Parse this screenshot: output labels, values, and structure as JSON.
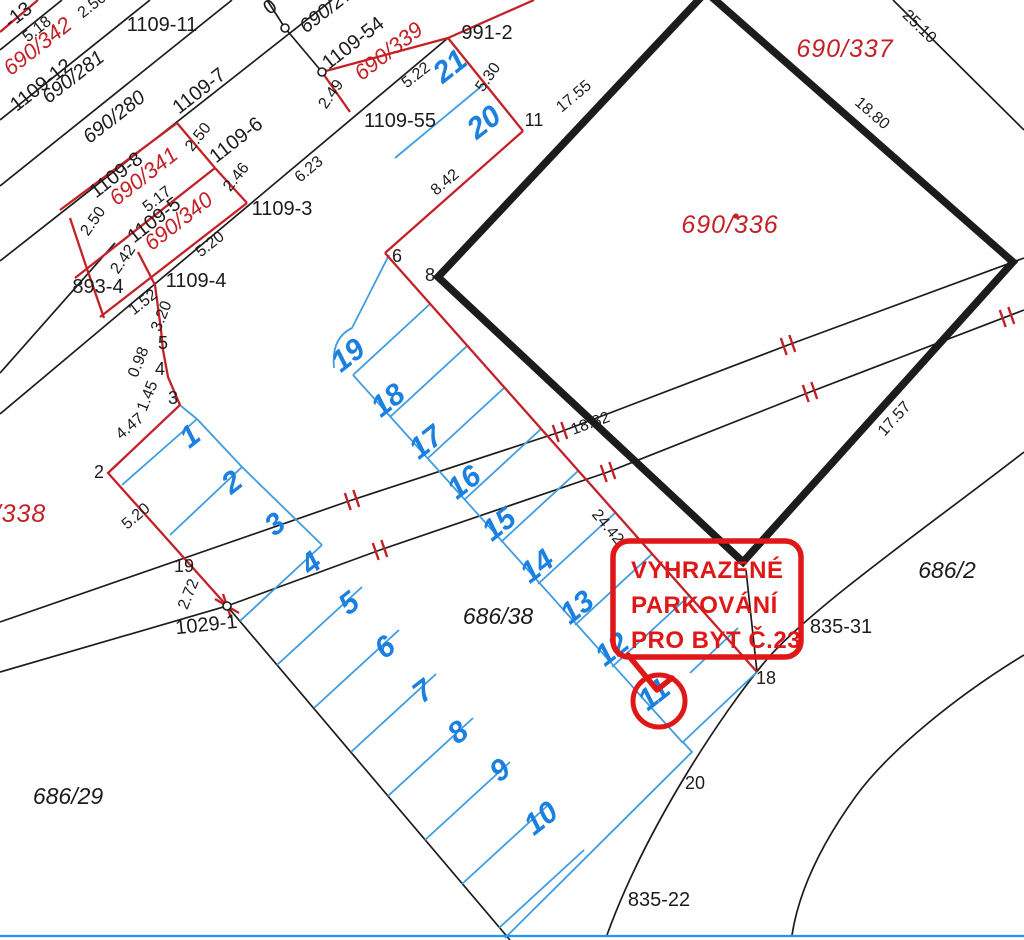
{
  "map": {
    "title": "cadastral-parcel-map",
    "colors": {
      "black": "#1c1c1c",
      "red_line": "#c42127",
      "red_text": "#c42127",
      "callout_red": "#e01717",
      "blue_number": "#1b80e0",
      "blue_line": "#3f9ce2",
      "background": "#ffffff"
    },
    "callout": {
      "lines": [
        "VYHRAZENÉ",
        "PARKOVÁNÍ",
        "PRO BYT Č.23"
      ],
      "box": [
        613,
        541,
        188,
        116,
        16
      ],
      "tail_path": "M628,655 L657,690 L672,678",
      "circle": [
        659,
        701,
        26
      ],
      "text_x": 631,
      "text_ys": [
        578,
        613,
        648
      ]
    },
    "labels": [
      {
        "t": "-13",
        "x": 22,
        "y": 20,
        "r": -38,
        "c": "pid",
        "s": 18
      },
      {
        "t": "2.50",
        "x": 95,
        "y": 9,
        "r": -38,
        "c": "dim"
      },
      {
        "t": "0",
        "x": 274,
        "y": 12,
        "r": -38,
        "c": "pid"
      },
      {
        "t": "5.18",
        "x": 40,
        "y": 33,
        "r": -38,
        "c": "dim"
      },
      {
        "t": "1109-11",
        "x": 162,
        "y": 31,
        "r": 0,
        "c": "pid"
      },
      {
        "t": "1109-12",
        "x": 45,
        "y": 90,
        "r": -38,
        "c": "pid"
      },
      {
        "t": "690/281",
        "x": 77,
        "y": 82,
        "r": -38,
        "c": "pidi"
      },
      {
        "t": "690/280",
        "x": 118,
        "y": 122,
        "r": -38,
        "c": "pidi"
      },
      {
        "t": "1109-7",
        "x": 203,
        "y": 96,
        "r": -38,
        "c": "pid"
      },
      {
        "t": "2.50",
        "x": 202,
        "y": 140,
        "r": -52,
        "c": "dim"
      },
      {
        "t": "1109-6",
        "x": 240,
        "y": 145,
        "r": -38,
        "c": "pid"
      },
      {
        "t": "2.46",
        "x": 240,
        "y": 180,
        "r": -52,
        "c": "dim"
      },
      {
        "t": "6.23",
        "x": 312,
        "y": 173,
        "r": -40,
        "c": "dim"
      },
      {
        "t": "1109-8",
        "x": 120,
        "y": 180,
        "r": -38,
        "c": "pid"
      },
      {
        "t": "5.17",
        "x": 160,
        "y": 203,
        "r": -38,
        "c": "dim"
      },
      {
        "t": "1109-5",
        "x": 158,
        "y": 225,
        "r": -38,
        "c": "pid"
      },
      {
        "t": "2.50",
        "x": 97,
        "y": 224,
        "r": -55,
        "c": "dim"
      },
      {
        "t": "2.42",
        "x": 127,
        "y": 262,
        "r": -55,
        "c": "dim"
      },
      {
        "t": "5.20",
        "x": 213,
        "y": 248,
        "r": -38,
        "c": "dim"
      },
      {
        "t": "1109-3",
        "x": 282,
        "y": 215,
        "r": 0,
        "c": "pid"
      },
      {
        "t": "1109-4",
        "x": 196,
        "y": 287,
        "r": 0,
        "c": "pid"
      },
      {
        "t": "893-4",
        "x": 98,
        "y": 293,
        "r": 0,
        "c": "pid"
      },
      {
        "t": "1.52",
        "x": 146,
        "y": 306,
        "r": -38,
        "c": "dim"
      },
      {
        "t": "3.20",
        "x": 166,
        "y": 318,
        "r": -68,
        "c": "dim"
      },
      {
        "t": "5",
        "x": 163,
        "y": 349,
        "r": 0,
        "c": "pt"
      },
      {
        "t": "0.98",
        "x": 143,
        "y": 364,
        "r": -68,
        "c": "dim"
      },
      {
        "t": "4",
        "x": 160,
        "y": 375,
        "r": 0,
        "c": "pt"
      },
      {
        "t": "1.45",
        "x": 152,
        "y": 398,
        "r": -68,
        "c": "dim"
      },
      {
        "t": "3",
        "x": 173,
        "y": 404,
        "r": 0,
        "c": "pt"
      },
      {
        "t": "4.47",
        "x": 133,
        "y": 430,
        "r": -40,
        "c": "dim"
      },
      {
        "t": "2",
        "x": 99,
        "y": 478,
        "r": 0,
        "c": "pt"
      },
      {
        "t": "5.20",
        "x": 139,
        "y": 520,
        "r": -40,
        "c": "dim"
      },
      {
        "t": "19",
        "x": 184,
        "y": 572,
        "r": 0,
        "c": "pt"
      },
      {
        "t": "2.72",
        "x": 193,
        "y": 596,
        "r": -68,
        "c": "dim"
      },
      {
        "t": "1029-1",
        "x": 207,
        "y": 631,
        "r": -6,
        "c": "pid"
      },
      {
        "t": "690/27",
        "x": 330,
        "y": 15,
        "r": -38,
        "c": "pidi"
      },
      {
        "t": "1109-54",
        "x": 357,
        "y": 48,
        "r": -38,
        "c": "pid"
      },
      {
        "t": "5.22",
        "x": 419,
        "y": 79,
        "r": -38,
        "c": "dim"
      },
      {
        "t": "991-2",
        "x": 487,
        "y": 39,
        "r": 0,
        "c": "pid"
      },
      {
        "t": "5.30",
        "x": 492,
        "y": 80,
        "r": -55,
        "c": "dim"
      },
      {
        "t": "11",
        "x": 534,
        "y": 126,
        "r": 0,
        "c": "pt"
      },
      {
        "t": "17.55",
        "x": 577,
        "y": 100,
        "r": -40,
        "c": "dim"
      },
      {
        "t": "8.42",
        "x": 448,
        "y": 186,
        "r": -40,
        "c": "dim"
      },
      {
        "t": "2.49",
        "x": 335,
        "y": 97,
        "r": -55,
        "c": "dim"
      },
      {
        "t": "1109-55",
        "x": 400,
        "y": 127,
        "r": 0,
        "c": "pid"
      },
      {
        "t": "6",
        "x": 397,
        "y": 262,
        "r": 0,
        "c": "pt"
      },
      {
        "t": "8",
        "x": 430,
        "y": 281,
        "r": 0,
        "c": "pt"
      },
      {
        "t": "25.10",
        "x": 916,
        "y": 30,
        "r": 44,
        "c": "dim"
      },
      {
        "t": "18.80",
        "x": 869,
        "y": 117,
        "r": 41,
        "c": "dim"
      },
      {
        "t": "17.57",
        "x": 898,
        "y": 422,
        "r": -48,
        "c": "dim"
      },
      {
        "t": "18.82",
        "x": 592,
        "y": 428,
        "r": -20,
        "c": "dim"
      },
      {
        "t": "24.42",
        "x": 604,
        "y": 530,
        "r": 50,
        "c": "dim"
      },
      {
        "t": "686/38",
        "x": 498,
        "y": 624,
        "r": 0,
        "c": "pidb"
      },
      {
        "t": "686/29",
        "x": 68,
        "y": 804,
        "r": 0,
        "c": "pidb"
      },
      {
        "t": "686/2",
        "x": 947,
        "y": 578,
        "r": 0,
        "c": "pidb"
      },
      {
        "t": "835-31",
        "x": 841,
        "y": 633,
        "r": 0,
        "c": "pid"
      },
      {
        "t": "18",
        "x": 766,
        "y": 684,
        "r": 0,
        "c": "pt"
      },
      {
        "t": "20",
        "x": 695,
        "y": 789,
        "r": 0,
        "c": "pt"
      },
      {
        "t": "835-22",
        "x": 659,
        "y": 906,
        "r": 0,
        "c": "pid"
      },
      {
        "t": "690/342",
        "x": 42,
        "y": 52,
        "r": -38,
        "c": "red"
      },
      {
        "t": "690/341",
        "x": 148,
        "y": 182,
        "r": -38,
        "c": "red"
      },
      {
        "t": "690/340",
        "x": 183,
        "y": 227,
        "r": -38,
        "c": "red"
      },
      {
        "t": "690/339",
        "x": 393,
        "y": 57,
        "r": -38,
        "c": "red"
      },
      {
        "t": "690/337",
        "x": 845,
        "y": 57,
        "r": 0,
        "c": "redbig"
      },
      {
        "t": "690/336",
        "x": 730,
        "y": 233,
        "r": 0,
        "c": "redbig"
      },
      {
        "t": "/338",
        "x": 20,
        "y": 522,
        "r": 0,
        "c": "redbig"
      }
    ],
    "stall_numbers": [
      {
        "n": "1",
        "x": 196,
        "y": 444
      },
      {
        "n": "2",
        "x": 238,
        "y": 490
      },
      {
        "n": "3",
        "x": 281,
        "y": 532
      },
      {
        "n": "4",
        "x": 317,
        "y": 571
      },
      {
        "n": "5",
        "x": 355,
        "y": 611
      },
      {
        "n": "6",
        "x": 391,
        "y": 655
      },
      {
        "n": "7",
        "x": 429,
        "y": 699
      },
      {
        "n": "8",
        "x": 464,
        "y": 740
      },
      {
        "n": "9",
        "x": 506,
        "y": 778
      },
      {
        "n": "10",
        "x": 547,
        "y": 826
      },
      {
        "n": "11",
        "x": 660,
        "y": 702
      },
      {
        "n": "12",
        "x": 618,
        "y": 657
      },
      {
        "n": "13",
        "x": 583,
        "y": 615
      },
      {
        "n": "14",
        "x": 543,
        "y": 574
      },
      {
        "n": "15",
        "x": 505,
        "y": 532
      },
      {
        "n": "16",
        "x": 470,
        "y": 490
      },
      {
        "n": "17",
        "x": 432,
        "y": 450
      },
      {
        "n": "18",
        "x": 394,
        "y": 408
      },
      {
        "n": "19",
        "x": 354,
        "y": 363
      },
      {
        "n": "20",
        "x": 490,
        "y": 130
      },
      {
        "n": "21",
        "x": 456,
        "y": 74
      }
    ],
    "geometry": {
      "black_segments": [
        [
          62,
          0,
          0,
          50
        ],
        [
          150,
          0,
          0,
          120
        ],
        [
          232,
          0,
          0,
          186
        ],
        [
          332,
          0,
          0,
          261
        ],
        [
          448,
          38,
          0,
          414
        ],
        [
          0,
          373,
          115,
          243
        ],
        [
          267,
          0,
          285,
          28
        ],
        [
          285,
          28,
          322,
          72
        ],
        [
          893,
          0,
          1024,
          130
        ],
        [
          227,
          606,
          510,
          940
        ],
        [
          746,
          570,
          757,
          672
        ]
      ],
      "black_polylines": [
        [
          [
            0,
            622
          ],
          [
            352,
            500
          ],
          [
            560,
            432
          ],
          [
            788,
            345
          ],
          [
            1024,
            258
          ]
        ],
        [
          [
            0,
            672
          ],
          [
            227,
            606
          ],
          [
            380,
            550
          ],
          [
            608,
            472
          ],
          [
            810,
            392
          ],
          [
            1024,
            310
          ]
        ]
      ],
      "black_paths": [
        "M1024,452 C930,525 815,605 768,658 C720,715 645,830 607,935",
        "M1024,655 C955,697 888,752 856,796 C822,843 799,890 792,935"
      ],
      "building_path": "M706,-8 L438,277 L743,562 L1013,262 Z",
      "red_segments": [
        [
          0,
          32,
          38,
          0
        ],
        [
          60,
          210,
          177,
          123
        ],
        [
          75,
          278,
          215,
          168
        ],
        [
          100,
          317,
          247,
          203
        ],
        [
          177,
          123,
          215,
          168
        ],
        [
          215,
          168,
          247,
          203
        ],
        [
          70,
          218,
          86,
          266
        ],
        [
          86,
          266,
          104,
          318
        ],
        [
          534,
          0,
          448,
          38
        ],
        [
          448,
          38,
          322,
          72
        ],
        [
          322,
          72,
          350,
          112
        ],
        [
          448,
          38,
          523,
          131
        ],
        [
          523,
          131,
          385,
          253
        ],
        [
          385,
          253,
          757,
          672
        ]
      ],
      "red_polylines": [
        [
          [
            138,
            252
          ],
          [
            155,
            285
          ],
          [
            161,
            330
          ],
          [
            163,
            350
          ],
          [
            168,
            377
          ],
          [
            180,
            405
          ],
          [
            108,
            473
          ],
          [
            227,
            606
          ]
        ]
      ],
      "road_ticks": [
        [
          352,
          500
        ],
        [
          560,
          432
        ],
        [
          788,
          345
        ],
        [
          380,
          550
        ],
        [
          608,
          472
        ],
        [
          810,
          392
        ],
        [
          1007,
          317
        ]
      ],
      "junction_x": [
        227,
        606
      ],
      "vertex_circles": [
        [
          285,
          28
        ],
        [
          322,
          72
        ],
        [
          227,
          606
        ]
      ],
      "red_dot": [
        736,
        216
      ],
      "blue_segments": [
        [
          483,
          85,
          395,
          158
        ],
        [
          181,
          406,
          197,
          419
        ],
        [
          197,
          419,
          122,
          485
        ],
        [
          242,
          467,
          170,
          535
        ],
        [
          197,
          419,
          242,
          467
        ],
        [
          242,
          467,
          322,
          545
        ],
        [
          322,
          545,
          240,
          621
        ],
        [
          362,
          587,
          277,
          665
        ],
        [
          399,
          630,
          314,
          708
        ],
        [
          436,
          674,
          351,
          752
        ],
        [
          473,
          718,
          388,
          796
        ],
        [
          510,
          762,
          425,
          840
        ],
        [
          547,
          806,
          462,
          884
        ],
        [
          584,
          850,
          499,
          928
        ],
        [
          430,
          304,
          353,
          375
        ],
        [
          467,
          346,
          390,
          417
        ],
        [
          504,
          388,
          427,
          459
        ],
        [
          541,
          429,
          464,
          500
        ],
        [
          578,
          471,
          501,
          542
        ],
        [
          615,
          513,
          538,
          584
        ],
        [
          652,
          554,
          575,
          625
        ],
        [
          689,
          596,
          612,
          667
        ],
        [
          738,
          628,
          690,
          673
        ],
        [
          353,
          375,
          683,
          743
        ]
      ],
      "blue_polylines": [
        [
          [
            757,
            672
          ],
          [
            683,
            742
          ],
          [
            692,
            752
          ],
          [
            505,
            938
          ]
        ]
      ],
      "blue_paths": [
        "M389,255 L352,328 Q331,338 334,368"
      ],
      "bottom_line": [
        0,
        936,
        1024,
        936
      ]
    }
  }
}
